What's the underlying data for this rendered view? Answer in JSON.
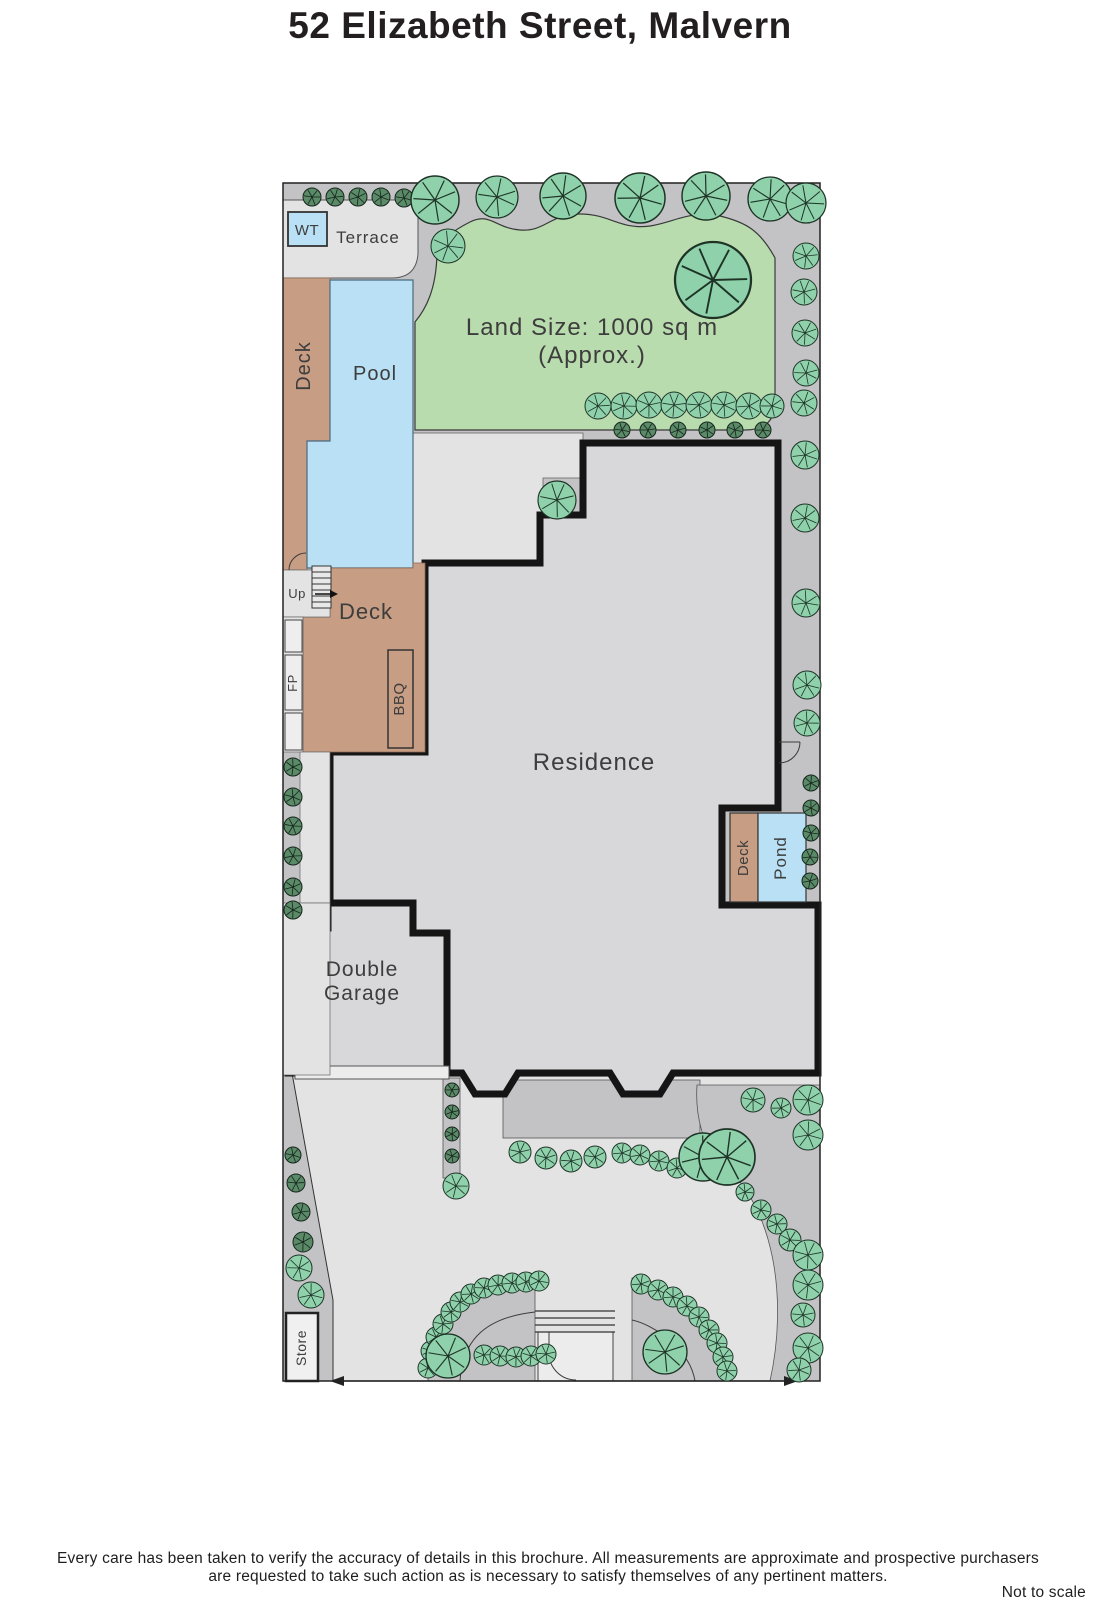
{
  "title": "52 Elizabeth Street, Malvern",
  "plan": {
    "wt": "WT",
    "terrace": "Terrace",
    "deck_left": "Deck",
    "pool": "Pool",
    "land_size_1": "Land Size: 1000 sq m",
    "land_size_2": "(Approx.)",
    "up": "Up",
    "deck_main": "Deck",
    "fp": "FP",
    "bbq": "BBQ",
    "residence": "Residence",
    "deck_right": "Deck",
    "pond": "Pond",
    "garage_1": "Double",
    "garage_2": "Garage",
    "store": "Store"
  },
  "footer": {
    "line1": "Every care has been taken to verify the accuracy of details in this brochure.  All measurements are approximate and prospective purchasers",
    "line2": "are requested to take such action as is necessary to satisfy themselves of any pertinent matters.",
    "note": "Not to scale"
  },
  "colors": {
    "path_gray": "#c3c3c5",
    "light_gray": "#e3e3e4",
    "residence_gray": "#d8d8da",
    "lawn_green": "#b9dcae",
    "deck_brown": "#c79d84",
    "water_blue": "#b9e0f4",
    "tree_fill": "#8ed1ab",
    "tree_stroke": "#1e3326",
    "shrub_fill": "#5a8a68",
    "shrub_stroke": "#15241a",
    "wall_black": "#151515"
  },
  "trees": [
    [
      312,
      197,
      9,
      "s"
    ],
    [
      335,
      197,
      9,
      "s"
    ],
    [
      358,
      197,
      9,
      "s"
    ],
    [
      381,
      197,
      9,
      "s"
    ],
    [
      404,
      198,
      9,
      "s"
    ],
    [
      435,
      200,
      24,
      "g"
    ],
    [
      497,
      197,
      21,
      "g"
    ],
    [
      563,
      196,
      23,
      "g"
    ],
    [
      640,
      198,
      25,
      "g"
    ],
    [
      706,
      196,
      24,
      "g"
    ],
    [
      770,
      199,
      22,
      "g"
    ],
    [
      806,
      203,
      20,
      "g"
    ],
    [
      448,
      246,
      17,
      "g"
    ],
    [
      806,
      256,
      13,
      "g"
    ],
    [
      713,
      280,
      38,
      "g"
    ],
    [
      804,
      292,
      13,
      "g"
    ],
    [
      805,
      333,
      13,
      "g"
    ],
    [
      806,
      373,
      13,
      "g"
    ],
    [
      804,
      403,
      13,
      "g"
    ],
    [
      805,
      455,
      14,
      "g"
    ],
    [
      805,
      518,
      14,
      "g"
    ],
    [
      806,
      603,
      14,
      "g"
    ],
    [
      807,
      685,
      14,
      "g"
    ],
    [
      807,
      723,
      13,
      "g"
    ],
    [
      598,
      406,
      13,
      "g"
    ],
    [
      624,
      406,
      13,
      "g"
    ],
    [
      649,
      405,
      13,
      "g"
    ],
    [
      674,
      405,
      13,
      "g"
    ],
    [
      699,
      405,
      13,
      "g"
    ],
    [
      724,
      405,
      13,
      "g"
    ],
    [
      749,
      406,
      13,
      "g"
    ],
    [
      772,
      406,
      12,
      "g"
    ],
    [
      622,
      430,
      8,
      "s"
    ],
    [
      648,
      430,
      8,
      "s"
    ],
    [
      678,
      430,
      8,
      "s"
    ],
    [
      707,
      430,
      8,
      "s"
    ],
    [
      735,
      430,
      8,
      "s"
    ],
    [
      763,
      430,
      8,
      "s"
    ],
    [
      557,
      500,
      19,
      "g"
    ],
    [
      811,
      783,
      8,
      "s"
    ],
    [
      811,
      808,
      8,
      "s"
    ],
    [
      811,
      833,
      8,
      "s"
    ],
    [
      810,
      857,
      8,
      "s"
    ],
    [
      810,
      881,
      8,
      "s"
    ],
    [
      293,
      767,
      9,
      "s"
    ],
    [
      293,
      797,
      9,
      "s"
    ],
    [
      293,
      826,
      9,
      "s"
    ],
    [
      293,
      856,
      9,
      "s"
    ],
    [
      293,
      887,
      9,
      "s"
    ],
    [
      293,
      910,
      9,
      "s"
    ],
    [
      293,
      1155,
      8,
      "s"
    ],
    [
      296,
      1183,
      9,
      "s"
    ],
    [
      301,
      1212,
      9,
      "s"
    ],
    [
      303,
      1242,
      10,
      "s"
    ],
    [
      299,
      1268,
      13,
      "g"
    ],
    [
      311,
      1295,
      13,
      "g"
    ],
    [
      452,
      1090,
      7,
      "s"
    ],
    [
      452,
      1112,
      7,
      "s"
    ],
    [
      452,
      1134,
      7,
      "s"
    ],
    [
      452,
      1156,
      7,
      "s"
    ],
    [
      456,
      1186,
      13,
      "g"
    ],
    [
      520,
      1152,
      11,
      "g"
    ],
    [
      546,
      1158,
      11,
      "g"
    ],
    [
      571,
      1161,
      11,
      "g"
    ],
    [
      595,
      1157,
      11,
      "g"
    ],
    [
      622,
      1153,
      10,
      "g"
    ],
    [
      640,
      1155,
      10,
      "g"
    ],
    [
      659,
      1161,
      10,
      "g"
    ],
    [
      677,
      1168,
      10,
      "g"
    ],
    [
      703,
      1157,
      24,
      "g"
    ],
    [
      428,
      1368,
      10,
      "g"
    ],
    [
      431,
      1351,
      10,
      "g"
    ],
    [
      436,
      1337,
      10,
      "g"
    ],
    [
      443,
      1324,
      10,
      "g"
    ],
    [
      451,
      1312,
      10,
      "g"
    ],
    [
      460,
      1302,
      10,
      "g"
    ],
    [
      471,
      1294,
      10,
      "g"
    ],
    [
      484,
      1288,
      10,
      "g"
    ],
    [
      498,
      1285,
      10,
      "g"
    ],
    [
      512,
      1283,
      10,
      "g"
    ],
    [
      526,
      1282,
      10,
      "g"
    ],
    [
      539,
      1281,
      10,
      "g"
    ],
    [
      484,
      1355,
      10,
      "g"
    ],
    [
      500,
      1356,
      10,
      "g"
    ],
    [
      516,
      1357,
      10,
      "g"
    ],
    [
      531,
      1356,
      10,
      "g"
    ],
    [
      546,
      1354,
      10,
      "g"
    ],
    [
      448,
      1356,
      22,
      "g"
    ],
    [
      641,
      1284,
      10,
      "g"
    ],
    [
      658,
      1290,
      10,
      "g"
    ],
    [
      673,
      1297,
      10,
      "g"
    ],
    [
      687,
      1306,
      10,
      "g"
    ],
    [
      699,
      1317,
      10,
      "g"
    ],
    [
      709,
      1330,
      10,
      "g"
    ],
    [
      717,
      1343,
      10,
      "g"
    ],
    [
      723,
      1357,
      10,
      "g"
    ],
    [
      727,
      1371,
      10,
      "g"
    ],
    [
      665,
      1352,
      22,
      "g"
    ],
    [
      753,
      1100,
      12,
      "g"
    ],
    [
      781,
      1108,
      10,
      "g"
    ],
    [
      808,
      1100,
      15,
      "g"
    ],
    [
      808,
      1135,
      15,
      "g"
    ],
    [
      727,
      1157,
      28,
      "g"
    ],
    [
      745,
      1192,
      9,
      "g"
    ],
    [
      761,
      1210,
      10,
      "g"
    ],
    [
      777,
      1224,
      10,
      "g"
    ],
    [
      790,
      1240,
      11,
      "g"
    ],
    [
      808,
      1255,
      15,
      "g"
    ],
    [
      808,
      1285,
      15,
      "g"
    ],
    [
      803,
      1315,
      12,
      "g"
    ],
    [
      808,
      1348,
      15,
      "g"
    ],
    [
      799,
      1370,
      12,
      "g"
    ]
  ]
}
